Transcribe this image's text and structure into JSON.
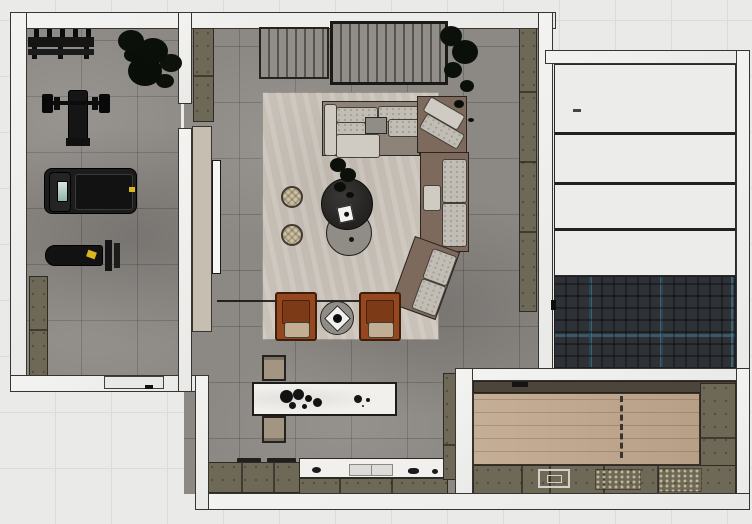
{
  "meta": {
    "view": "top-down-interior-floor-plan-render",
    "canvas_width": 752,
    "canvas_height": 524
  },
  "palette": {
    "bg": "#eaeae8",
    "grid": "#dbdbd8",
    "wall": "#f0f0ee",
    "line": "#38342f",
    "floor": "#8c8884",
    "rug": "#c9c2b9",
    "sofaFrame": "#8d8378",
    "sofaBrown": "#7d6a5c",
    "cushion": "#c2bdb4",
    "cushionLight": "#cfcbc3",
    "rust": "#95481f",
    "rustDark": "#4f2510",
    "seat": "#c2ae92",
    "pouf": "#cdc0a3",
    "tableDark": "#282726",
    "tableGray": "#908d86",
    "olive": "#6e6856",
    "oliveDark": "#4b453b",
    "marble": "#f1f0ed",
    "wood": "#c1a88e",
    "herring": "#2e3237",
    "herringBlue": "#4c87a0",
    "panel": "#ececea",
    "slat": "#918d88",
    "slatLine": "#57544f",
    "beige": "#c6beb0",
    "tv": "#f6f6f4",
    "stool": "#a29683",
    "blackItem": "#111111",
    "treadmill": "#1c1c1c",
    "screen": "#8fb3a4",
    "accentYellow": "#d8b71f"
  },
  "rooms": {
    "gym": {
      "floor": "dark-gray-tile",
      "items": [
        "dumbbell-rack",
        "bench-press-station",
        "treadmill",
        "incline-bench",
        "storage-cabinet",
        "potted-plant"
      ]
    },
    "living_room": {
      "floor": "dark-gray-tile",
      "items": [
        "area-rug",
        "sectional-sofa",
        "corner-section",
        "chaise-section",
        "round-coffee-table-dark",
        "round-coffee-table-gray",
        "pouf",
        "pouf",
        "armchair",
        "armchair",
        "round-side-table",
        "slatted-wardrobe-panel",
        "slatted-wardrobe-panel",
        "wall-shelf-left",
        "wall-shelf-right",
        "tv-panel",
        "tv",
        "potted-plant",
        "table-plant"
      ]
    },
    "kitchen": {
      "floor": "dark-gray-tile",
      "items": [
        "marble-island",
        "bar-stool",
        "bar-stool",
        "cooktop",
        "marble-counter",
        "sink",
        "base-cabinets",
        "tall-cabinet-column"
      ]
    },
    "right_wing": {
      "zones": [
        "white-paneled-area",
        "herringbone-deck"
      ]
    },
    "bottom_right_room": {
      "floor": "light-wood-plank",
      "items": [
        "counter-run",
        "sink",
        "side-cabinets",
        "top-trim-cabinet",
        "sliding-door-dashed-marker"
      ]
    }
  },
  "openings": [
    "gym-exterior-door",
    "gym-living-wall-gap"
  ],
  "counts": {
    "pouf": 2,
    "armchair": 2,
    "bar_stool": 2,
    "plants": 3
  }
}
